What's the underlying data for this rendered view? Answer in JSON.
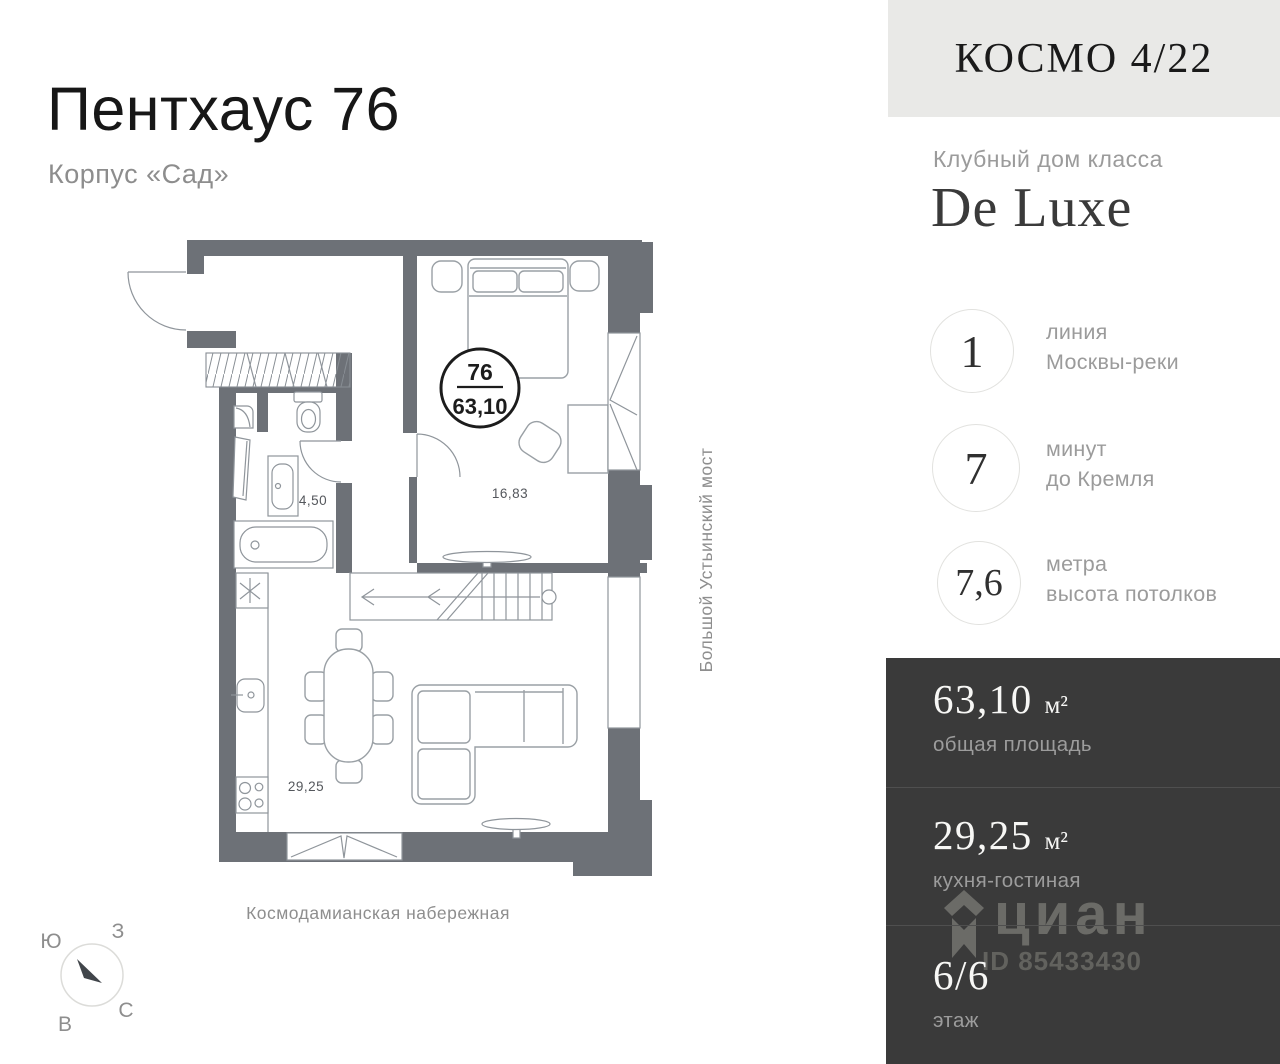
{
  "listing": {
    "title": "Пентхаус 76",
    "subtitle": "Корпус «Сад»"
  },
  "plan": {
    "badge": {
      "number": "76",
      "area": "63,10"
    },
    "rooms": {
      "bedroom": "16,83",
      "bathroom": "4,50",
      "kitchen_living": "29,25"
    },
    "streets": {
      "bottom": "Космодамианская набережная",
      "right": "Большой Устьинский мост"
    },
    "compass": {
      "south": "Ю",
      "west": "З",
      "north": "С",
      "east": "В"
    }
  },
  "sidebar": {
    "logo": "КОСМО 4/22",
    "building_class": {
      "label": "Клубный дом класса",
      "value": "De Luxe"
    },
    "features": [
      {
        "value": "1",
        "line1": "линия",
        "line2": "Москвы-реки"
      },
      {
        "value": "7",
        "line1": "минут",
        "line2": "до Кремля"
      },
      {
        "value": "7,6",
        "line1": "метра",
        "line2": "высота потолков"
      }
    ],
    "stats": [
      {
        "value": "63,10",
        "unit": "м²",
        "label": "общая площадь"
      },
      {
        "value": "29,25",
        "unit": "м²",
        "label": "кухня-гостиная"
      },
      {
        "value": "6/6",
        "unit": "",
        "label": "этаж"
      }
    ],
    "watermark": {
      "brand": "циан",
      "id": "ID 85433430"
    }
  },
  "colors": {
    "wall": "#6d7177",
    "panel_dark": "#3a3a3a",
    "header_gray": "#e9e9e7",
    "muted_text": "#9b9b9b",
    "outline": "#9aa0a5"
  }
}
